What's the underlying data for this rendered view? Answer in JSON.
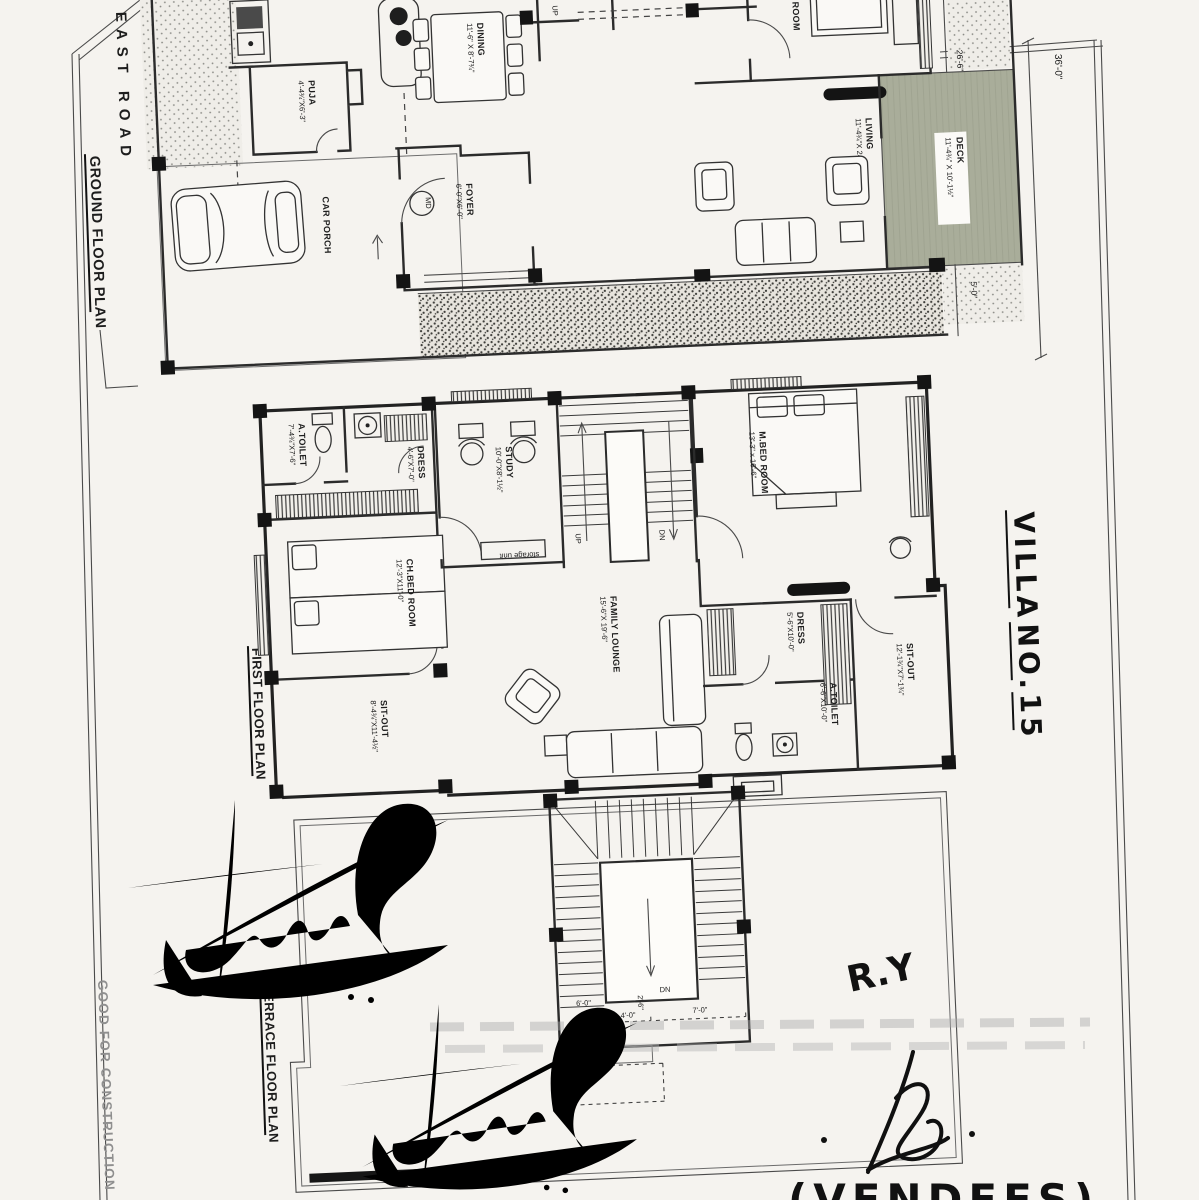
{
  "colors": {
    "deck_green": "#a9ad9a",
    "ink": "#1c1c1c",
    "stamp_gray": "#8f8f8f",
    "paper": "#f5f3ef"
  },
  "side": {
    "east_road": "EAST ROAD",
    "ground_floor_plan": "GROUND FLOOR PLAN",
    "first_floor_plan": "FIRST FLOOR PLAN",
    "terrace_floor_plan": "TERRACE FLOOR PLAN",
    "good_for_construction": "GOOD FOR CONSTRUCTION"
  },
  "handwritten": {
    "villa": "VILLA",
    "no": "NO.",
    "fifteen": "15",
    "initials": "R.Y",
    "vendees": "(VENDEES)"
  },
  "ground": {
    "puja_name": "PUJA",
    "puja_dim": "4'-4¾\"X6'-3\"",
    "dining_name": "DINING",
    "dining_dim": "11'-6\" X 8'-7¾\"",
    "foyer_name": "FOYER",
    "foyer_dim": "6'-0\"X6'-0\"",
    "living_name": "LIVING",
    "living_dim": "11'-4¾\"X 24'-0\"",
    "bed_name": "BED ROOM",
    "bed_dim": "12'-0\"",
    "deck_name": "DECK",
    "deck_dim": "11'-4¾\" X 10'-1½\"",
    "car_porch": "CAR PORCH",
    "door_mark": "MD",
    "up": "UP",
    "dim_right_upper": "26'-6\"",
    "dim_right_total": "36'-0\"",
    "dim_right_lower": "5'-0\""
  },
  "first": {
    "atoilet_l_name": "A.TOILET",
    "atoilet_l_dim": "7'-4¾\"X7'-6\"",
    "dress_l_name": "DRESS",
    "dress_l_dim": "4'-6\"X7'-0\"",
    "study_name": "STUDY",
    "study_dim": "10'-0\"X8'-1½\"",
    "storage": "storage unit",
    "chbed_name": "CH.BED ROOM",
    "chbed_dim": "12'-3\"X11'-0\"",
    "mbed_name": "M.BED ROOM",
    "mbed_dim": "13'-3\" x 16'-6\"",
    "lounge_name": "FAMILY LOUNGE",
    "lounge_dim": "15'-6\"X 19'-6\"",
    "sitout_l_name": "SIT-OUT",
    "sitout_l_dim": "8'-4¾\"X11'-4½\"",
    "dress_r_name": "DRESS",
    "dress_r_dim": "5'-6\"X10'-0\"",
    "atoilet_r_name": "A.TOILET",
    "atoilet_r_dim": "6'-6\"X10'-0\"",
    "sitout_r_name": "SIT-OUT",
    "sitout_r_dim": "12'-1¾\"X7'-1¾\"",
    "up": "UP",
    "dn": "DN"
  },
  "terrace": {
    "dn": "DN",
    "dim_a": "4'-0\"",
    "dim_b": "7'-0\"",
    "dim_c": "6'-0\"",
    "dim_d": "2'-6\""
  }
}
